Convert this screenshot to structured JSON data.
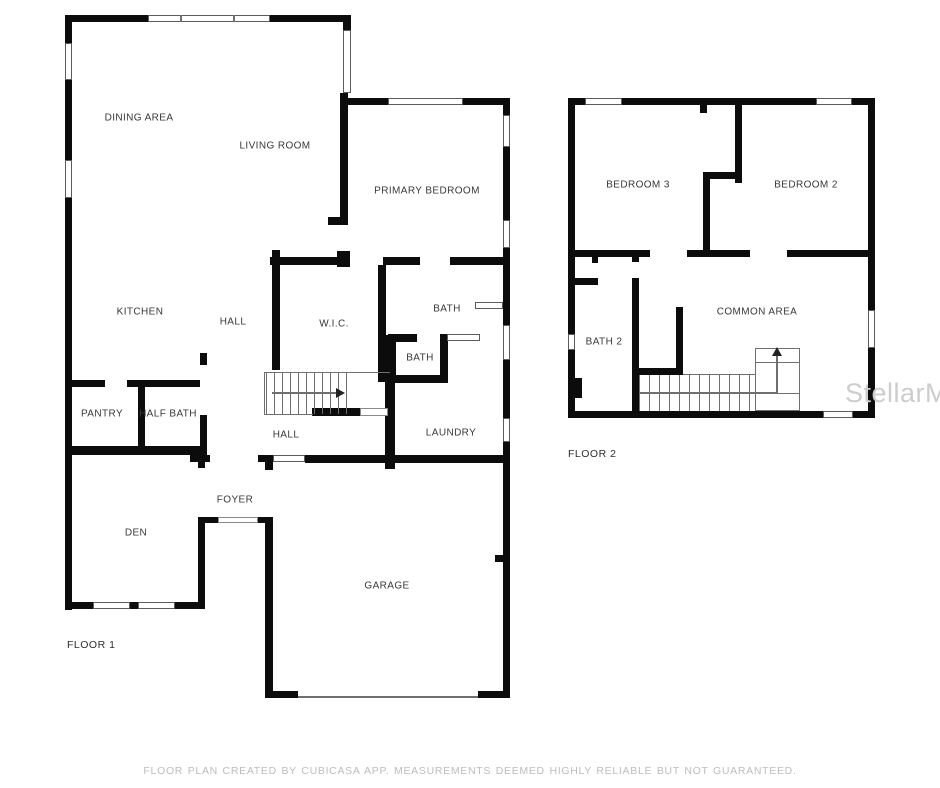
{
  "page": {
    "watermark": "StellarMLS",
    "disclaimer": "FLOOR PLAN CREATED BY CUBICASA APP. MEASUREMENTS DEEMED HIGHLY RELIABLE BUT NOT GUARANTEED."
  },
  "colors": {
    "wall": "#0c0c0c",
    "thin_line": "#6f6f6f",
    "label": "#383838",
    "watermark": "#cdcdcd",
    "disclaimer": "#bdbdbd",
    "background": "#ffffff"
  },
  "floor1": {
    "label": "FLOOR 1",
    "rooms": [
      "DINING AREA",
      "LIVING ROOM",
      "PRIMARY BEDROOM",
      "KITCHEN",
      "HALL",
      "W.I.C.",
      "BATH",
      "BATH",
      "PANTRY",
      "HALF BATH",
      "HALL",
      "LAUNDRY",
      "FOYER",
      "DEN",
      "GARAGE"
    ],
    "stair_direction": "right"
  },
  "floor2": {
    "label": "FLOOR 2",
    "rooms": [
      "BEDROOM 3",
      "BEDROOM 2",
      "BATH 2",
      "COMMON AREA"
    ],
    "stair_direction": "up"
  }
}
